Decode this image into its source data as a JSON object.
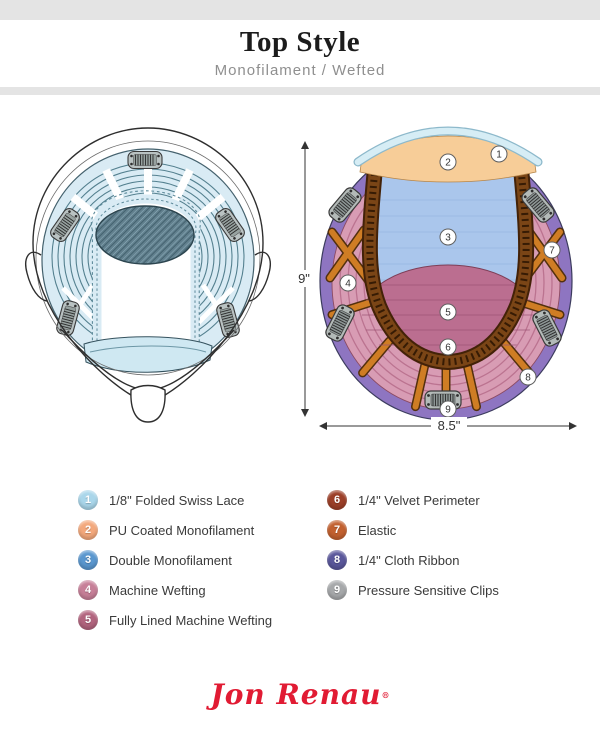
{
  "header": {
    "title": "Top Style",
    "subtitle": "Monofilament / Wefted"
  },
  "diagram": {
    "height_label": "9\"",
    "width_label": "8.5\"",
    "callouts": [
      "1",
      "2",
      "3",
      "4",
      "5",
      "6",
      "7",
      "8",
      "9"
    ],
    "colors": {
      "swiss_lace": "#d6edf5",
      "pu_monofilament": "#f7cd98",
      "double_monofilament": "#aac6ec",
      "machine_wefting": "#d89cb4",
      "lined_wefting": "#bb6e90",
      "velvet_perimeter": "#7a4516",
      "elastic": "#cf7d24",
      "cloth_ribbon": "#8e75c1",
      "clips": "#b3bab8"
    }
  },
  "legend": {
    "left": [
      {
        "num": "1",
        "label": "1/8\" Folded Swiss Lace",
        "color": "#a9d6ea"
      },
      {
        "num": "2",
        "label": "PU Coated Monofilament",
        "color": "#f3a87c"
      },
      {
        "num": "3",
        "label": "Double Monofilament",
        "color": "#5a97cf"
      },
      {
        "num": "4",
        "label": "Machine Wefting",
        "color": "#c77f98"
      },
      {
        "num": "5",
        "label": "Fully Lined Machine Wefting",
        "color": "#b2647e"
      }
    ],
    "right": [
      {
        "num": "6",
        "label": "1/4\" Velvet Perimeter",
        "color": "#9c3f28"
      },
      {
        "num": "7",
        "label": "Elastic",
        "color": "#c2602f"
      },
      {
        "num": "8",
        "label": "1/4\" Cloth Ribbon",
        "color": "#5a579b"
      },
      {
        "num": "9",
        "label": "Pressure Sensitive Clips",
        "color": "#a6a8aa"
      }
    ]
  },
  "footer": {
    "brand": "Jon Renau",
    "registered": "®"
  }
}
